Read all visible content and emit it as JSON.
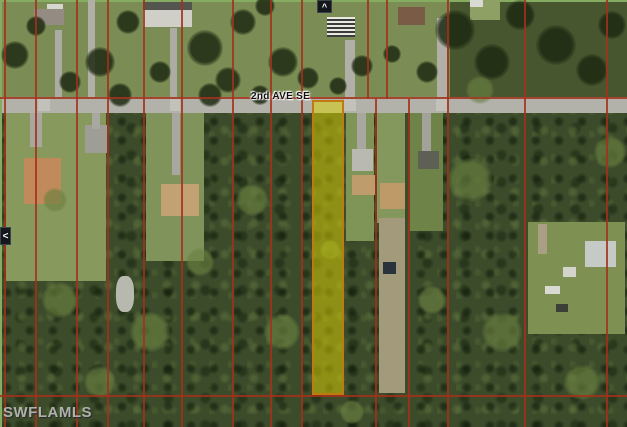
{
  "window": {
    "width": 627,
    "height": 427
  },
  "map": {
    "street_label": "2nd AVE SE",
    "watermark": "SWFLAMLS",
    "nav": {
      "pan_up_glyph": "^",
      "pan_left_glyph": "<"
    },
    "palette": {
      "parcel_line": "#a5301b",
      "highlight_fill": "rgba(222,212,0,0.5)",
      "highlight_border": "#c07a10",
      "road": "#b2b2aa",
      "forest": "#3c4c2b",
      "lawn": "#87995c",
      "tree_dark": "#1e2a12",
      "tree_light": "#698040",
      "frame_edge": "#86ac62"
    }
  },
  "map_features": {
    "zones": [
      [
        0,
        0,
        627,
        97,
        "#7b8d55",
        "top-residential-strip"
      ],
      [
        450,
        0,
        177,
        97,
        "#47562f",
        "top-forest-zone"
      ],
      [
        0,
        97,
        627,
        16,
        "#b2b2aa",
        "road-surface"
      ]
    ],
    "patches": [
      [
        0,
        0,
        627,
        2,
        "#86ac62"
      ],
      [
        0,
        0,
        2,
        427,
        "#86ac62"
      ],
      [
        6,
        113,
        100,
        168,
        "#87995c"
      ],
      [
        146,
        113,
        58,
        148,
        "#80935a"
      ],
      [
        346,
        113,
        28,
        128,
        "#7f9457"
      ],
      [
        377,
        113,
        28,
        110,
        "#84975c"
      ],
      [
        410,
        113,
        33,
        118,
        "#6e8347"
      ],
      [
        528,
        222,
        97,
        112,
        "#7e9153"
      ],
      [
        379,
        218,
        26,
        175,
        "#a29a7a"
      ],
      [
        470,
        0,
        30,
        20,
        "#8fa065"
      ],
      [
        30,
        113,
        12,
        34,
        "#a8a8a0"
      ],
      [
        85,
        125,
        22,
        28,
        "#9e9e96"
      ],
      [
        92,
        113,
        8,
        16,
        "#a8a8a0"
      ],
      [
        172,
        113,
        8,
        62,
        "#a8a8a0"
      ],
      [
        357,
        113,
        9,
        38,
        "#a8a8a0"
      ],
      [
        422,
        113,
        9,
        42,
        "#a2a29a"
      ],
      [
        437,
        18,
        10,
        79,
        "#b0b0a8"
      ],
      [
        345,
        40,
        10,
        57,
        "#b0b0a8"
      ],
      [
        88,
        0,
        7,
        97,
        "#b0b0a8"
      ],
      [
        55,
        30,
        7,
        67,
        "#acaca4"
      ],
      [
        170,
        28,
        7,
        69,
        "#acaca4"
      ],
      [
        538,
        224,
        9,
        30,
        "#a89f84"
      ],
      [
        38,
        99,
        12,
        12,
        "#c2c2ba"
      ],
      [
        170,
        99,
        10,
        12,
        "#c2c2ba"
      ],
      [
        344,
        99,
        12,
        12,
        "#c2c2ba"
      ],
      [
        436,
        99,
        11,
        12,
        "#c2c2ba"
      ],
      [
        116,
        276,
        18,
        36,
        "#b7b9ae",
        40
      ]
    ],
    "houses": [
      [
        47,
        4,
        16,
        9,
        "#d6d6d0"
      ],
      [
        34,
        9,
        30,
        16,
        "#948c82"
      ],
      [
        143,
        2,
        49,
        9,
        "#55554f"
      ],
      [
        143,
        10,
        49,
        17,
        "#cfcfc8"
      ],
      [
        327,
        17,
        28,
        20,
        "#e0e0da",
        true
      ],
      [
        398,
        7,
        27,
        18,
        "#7a5c46"
      ],
      [
        470,
        0,
        13,
        7,
        "#dadad4"
      ],
      [
        24,
        158,
        37,
        46,
        "#c08a5a"
      ],
      [
        161,
        184,
        38,
        32,
        "#c2a273"
      ],
      [
        352,
        149,
        21,
        22,
        "#b9b9b1"
      ],
      [
        352,
        175,
        23,
        20,
        "#bf9c6c"
      ],
      [
        380,
        183,
        25,
        26,
        "#bd9a68"
      ],
      [
        418,
        151,
        21,
        18,
        "#5f6055"
      ],
      [
        585,
        241,
        31,
        26,
        "#c6cac6"
      ],
      [
        383,
        262,
        13,
        12,
        "#2a333c"
      ],
      [
        545,
        286,
        15,
        8,
        "#d9d9d3"
      ],
      [
        556,
        304,
        12,
        8,
        "#3a4036"
      ],
      [
        563,
        267,
        13,
        10,
        "#d4d4cc"
      ]
    ],
    "trees_dark": [
      [
        15,
        55,
        14
      ],
      [
        100,
        62,
        15
      ],
      [
        128,
        22,
        12
      ],
      [
        205,
        48,
        18
      ],
      [
        243,
        22,
        13
      ],
      [
        283,
        62,
        15
      ],
      [
        308,
        78,
        11
      ],
      [
        228,
        80,
        13
      ],
      [
        362,
        66,
        11
      ],
      [
        392,
        54,
        9
      ],
      [
        455,
        30,
        20
      ],
      [
        492,
        62,
        18
      ],
      [
        520,
        15,
        15
      ],
      [
        556,
        45,
        20
      ],
      [
        592,
        70,
        16
      ],
      [
        612,
        25,
        14
      ],
      [
        160,
        72,
        11
      ],
      [
        70,
        82,
        11
      ],
      [
        36,
        26,
        10
      ],
      [
        265,
        6,
        10
      ],
      [
        338,
        86,
        9
      ],
      [
        427,
        72,
        11
      ],
      [
        210,
        95,
        12
      ],
      [
        120,
        95,
        12
      ],
      [
        260,
        95,
        10
      ]
    ],
    "trees_light": [
      [
        60,
        300,
        18
      ],
      [
        150,
        332,
        20
      ],
      [
        252,
        200,
        16
      ],
      [
        282,
        332,
        18
      ],
      [
        470,
        180,
        22
      ],
      [
        502,
        332,
        20
      ],
      [
        582,
        382,
        18
      ],
      [
        200,
        262,
        14
      ],
      [
        352,
        412,
        12
      ],
      [
        100,
        382,
        16
      ],
      [
        432,
        300,
        14
      ],
      [
        610,
        152,
        16
      ],
      [
        330,
        250,
        10
      ],
      [
        55,
        200,
        12
      ],
      [
        480,
        90,
        14
      ]
    ],
    "parcel_lines_v": [
      [
        4,
        0,
        427
      ],
      [
        35,
        0,
        427
      ],
      [
        76,
        0,
        427
      ],
      [
        107,
        0,
        427
      ],
      [
        143,
        0,
        427
      ],
      [
        181,
        0,
        427
      ],
      [
        232,
        0,
        427
      ],
      [
        270,
        0,
        427
      ],
      [
        301,
        0,
        427
      ],
      [
        367,
        0,
        99
      ],
      [
        386,
        0,
        99
      ],
      [
        375,
        99,
        427
      ],
      [
        408,
        99,
        427
      ],
      [
        447,
        0,
        427
      ],
      [
        524,
        0,
        427
      ],
      [
        606,
        0,
        427
      ]
    ],
    "parcel_lines_h": [
      [
        97,
        0,
        627
      ],
      [
        395,
        0,
        627
      ]
    ],
    "highlight_parcel": {
      "x": 312,
      "y": 100,
      "w": 32,
      "h": 295
    }
  }
}
